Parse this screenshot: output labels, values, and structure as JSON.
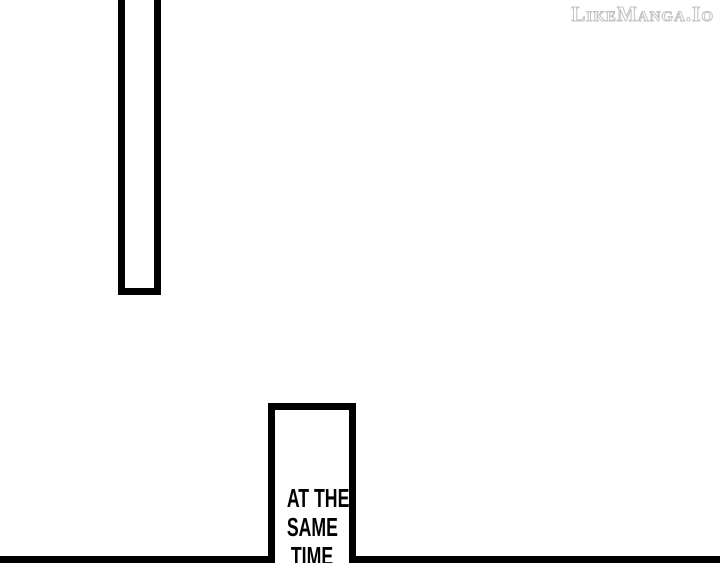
{
  "page": {
    "background_color": "#ffffff",
    "ink_color": "#000000"
  },
  "watermark": {
    "text": "LikeManga.Io",
    "outline_color": "#c4c4c4"
  },
  "caption": {
    "lines": [
      "AT THE",
      "SAME",
      "TIME"
    ]
  }
}
